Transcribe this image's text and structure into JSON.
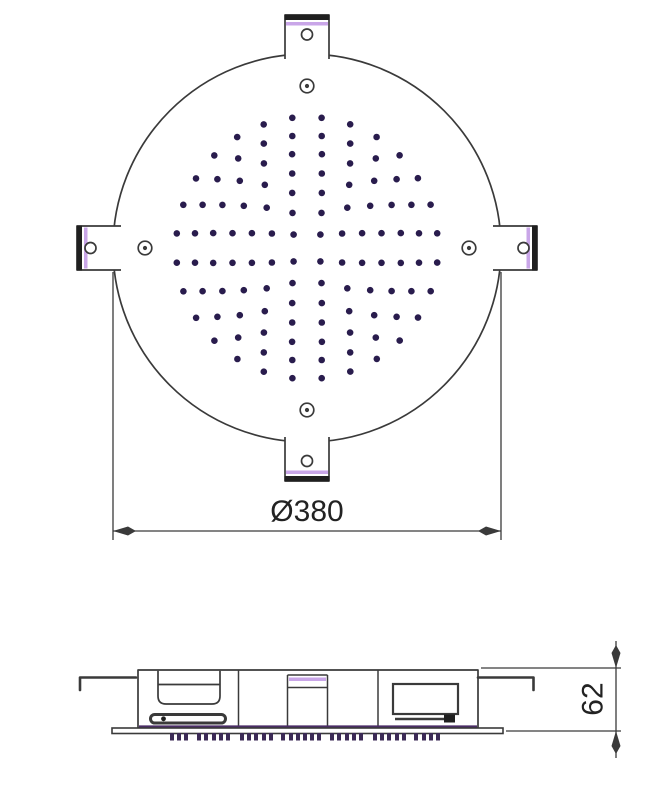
{
  "drawing": {
    "subject": "ceiling-mounted round shower head, dimensioned technical drawing",
    "views": [
      "top plan view",
      "side profile view"
    ]
  },
  "labels": {
    "diameter": "Ø380",
    "height": "62"
  },
  "colors": {
    "background": "#ffffff",
    "line": "#3a3a3a",
    "dark": "#1f1f1f",
    "text": "#222222",
    "accent_light": "#c9a6e8",
    "accent_dark": "#4a2d66",
    "dot": "#291c4d",
    "teeth": "#3b2a55"
  },
  "top_view": {
    "center": {
      "x": 307,
      "y": 248
    },
    "radius": 194,
    "screw_hole_offset": 162,
    "mounting_tab_count": 4,
    "screw_hole_count": 4,
    "dot_pattern": {
      "dot_radius": 3.3,
      "rings": [
        {
          "radius": 19,
          "count": 4,
          "offset_deg": 45
        },
        {
          "radius": 38,
          "count": 8,
          "offset_deg": 22.5
        },
        {
          "radius": 57,
          "count": 12,
          "offset_deg": 15
        },
        {
          "radius": 76,
          "count": 16,
          "offset_deg": 11.25
        },
        {
          "radius": 95,
          "count": 20,
          "offset_deg": 9
        },
        {
          "radius": 113,
          "count": 24,
          "offset_deg": 7.5
        },
        {
          "radius": 131,
          "count": 28,
          "offset_deg": 6.4
        }
      ]
    }
  },
  "side_view": {
    "teeth": {
      "x_start": 170,
      "x_end": 446,
      "y": 733,
      "tooth_width": 4,
      "height": 7.5,
      "gap_pattern": [
        3,
        3,
        9,
        3,
        4,
        3,
        3,
        10,
        3,
        3,
        4,
        3,
        8,
        4,
        3,
        3
      ]
    }
  }
}
